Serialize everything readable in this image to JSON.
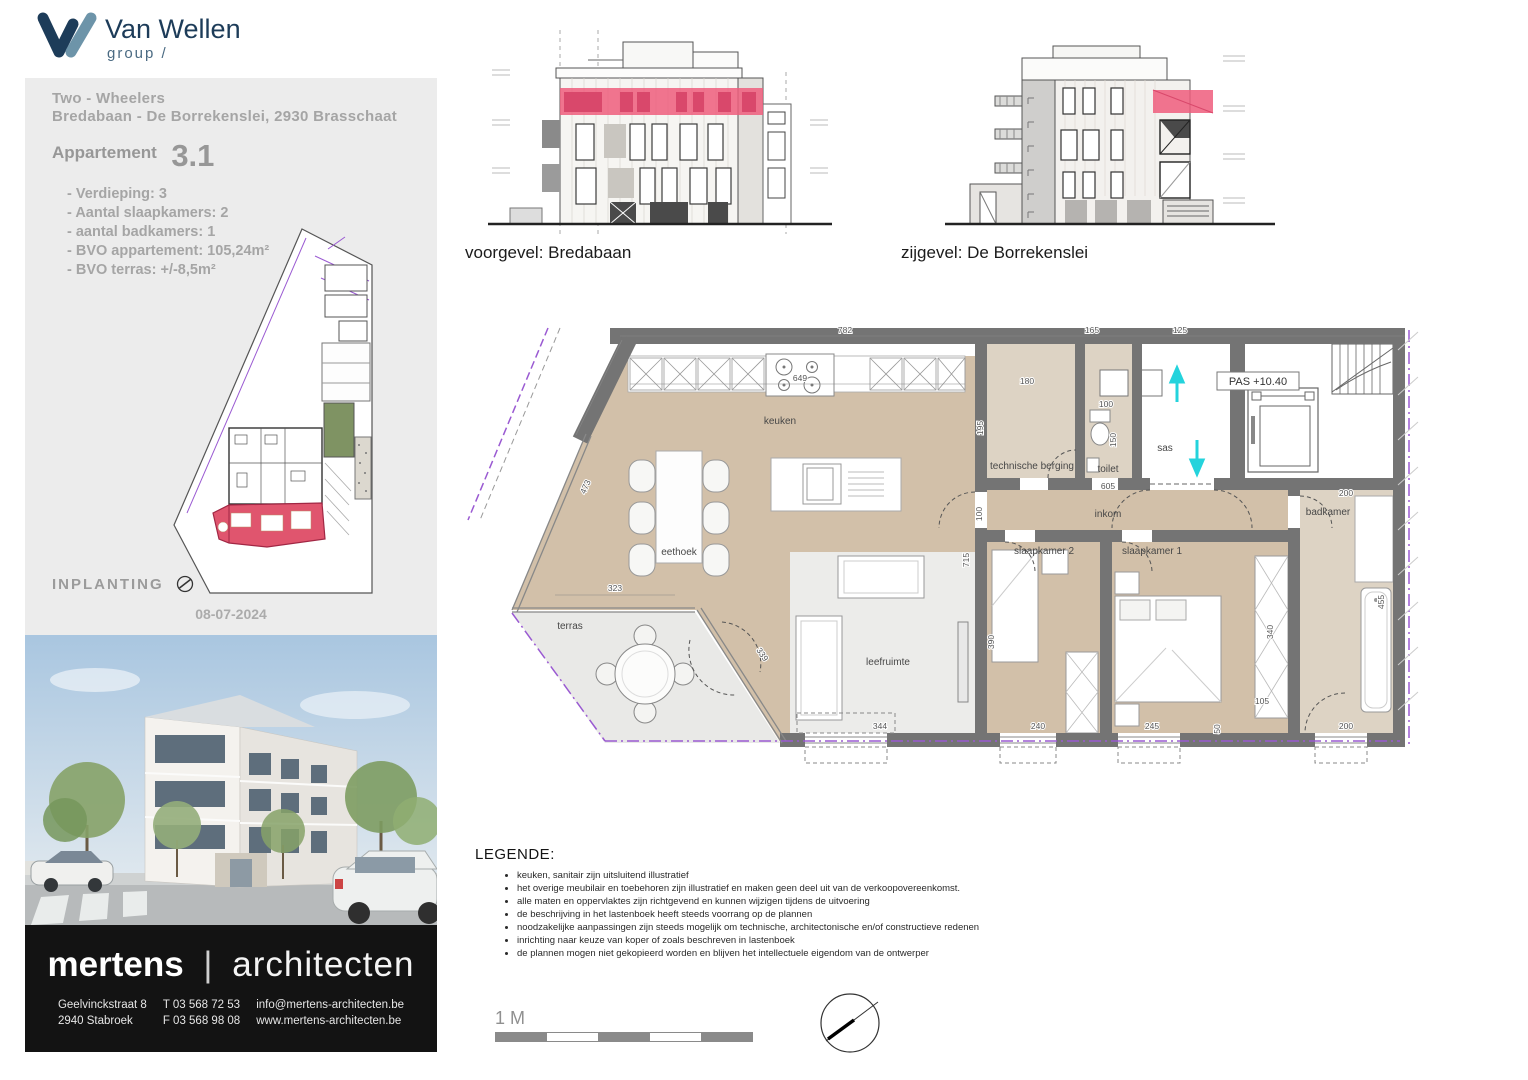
{
  "brand": {
    "name": "Van Wellen",
    "sub": "group /"
  },
  "info": {
    "project": "Two - Wheelers",
    "address": "Bredabaan - De Borrekenslei, 2930 Brasschaat",
    "apt_label": "Appartement",
    "apt_no": "3.1",
    "specs": [
      "- Verdieping: 3",
      "- Aantal slaapkamers: 2",
      "- aantal badkamers: 1",
      "- BVO appartement: 105,24m²",
      "- BVO terras: +/-8,5m²"
    ],
    "inplanting": "INPLANTING",
    "date": "08-07-2024"
  },
  "elev": {
    "front": "voorgevel: Bredabaan",
    "side": "zijgevel: De Borrekenslei"
  },
  "plan": {
    "pas_label": "PAS +10.40",
    "rooms": {
      "keuken": "keuken",
      "eethoek": "eethoek",
      "terras": "terras",
      "leefruimte": "leefruimte",
      "berging": "technische berging",
      "toilet": "toilet",
      "sas": "sas",
      "inkom": "inkom",
      "slaapkamer2": "slaapkamer 2",
      "slaapkamer1": "slaapkamer 1",
      "badkamer": "badkamer"
    },
    "dims": {
      "d782": "782",
      "d165": "165",
      "d125": "125",
      "d649": "649",
      "d180": "180",
      "d195": "195",
      "d100a": "100",
      "d150": "150",
      "d605": "605",
      "d100b": "100",
      "d715": "715",
      "d473": "473",
      "d323": "323",
      "d339": "339",
      "d344": "344",
      "d240": "240",
      "d245": "245",
      "d390": "390",
      "d340": "340",
      "d105": "105",
      "d50": "50",
      "d200a": "200",
      "d455": "455",
      "d200b": "200"
    }
  },
  "legend": {
    "title": "LEGENDE:",
    "items": [
      "keuken, sanitair zijn uitsluitend illustratief",
      "het overige meubilair en toebehoren zijn illustratief en maken geen deel uit van de verkoopovereenkomst.",
      "alle maten en oppervlaktes zijn richtgevend en kunnen wijzigen tijdens de uitvoering",
      "de beschrijving in het lastenboek heeft steeds voorrang op de plannen",
      "noodzakelijke aanpassingen zijn steeds mogelijk om technische, architectonische en/of constructieve redenen",
      "inrichting naar keuze van koper of zoals beschreven in lastenboek",
      "de plannen mogen niet gekopieerd worden en blijven het intellectuele eigendom van de ontwerper"
    ]
  },
  "scalebar": {
    "label": "1 M"
  },
  "firm": {
    "name1": "mertens",
    "sep": "|",
    "name2": "architecten",
    "addr1": "Geelvinckstraat 8",
    "addr2": "2940 Stabroek",
    "tel": "T 03 568 72 53",
    "fax": "F 03 568 98 08",
    "email": "info@mertens-architecten.be",
    "web": "www.mertens-architecten.be"
  },
  "colors": {
    "highlight_pink": "#ee5d7c",
    "plan_wall": "#747474",
    "plan_floor": "#d2c0a9",
    "terrace_floor": "#e9e9e7",
    "accent_purple": "#9a5ad2",
    "accent_cyan": "#24d3dc",
    "brand_navy": "#1d3c59",
    "brand_steel": "#6d94a9"
  }
}
